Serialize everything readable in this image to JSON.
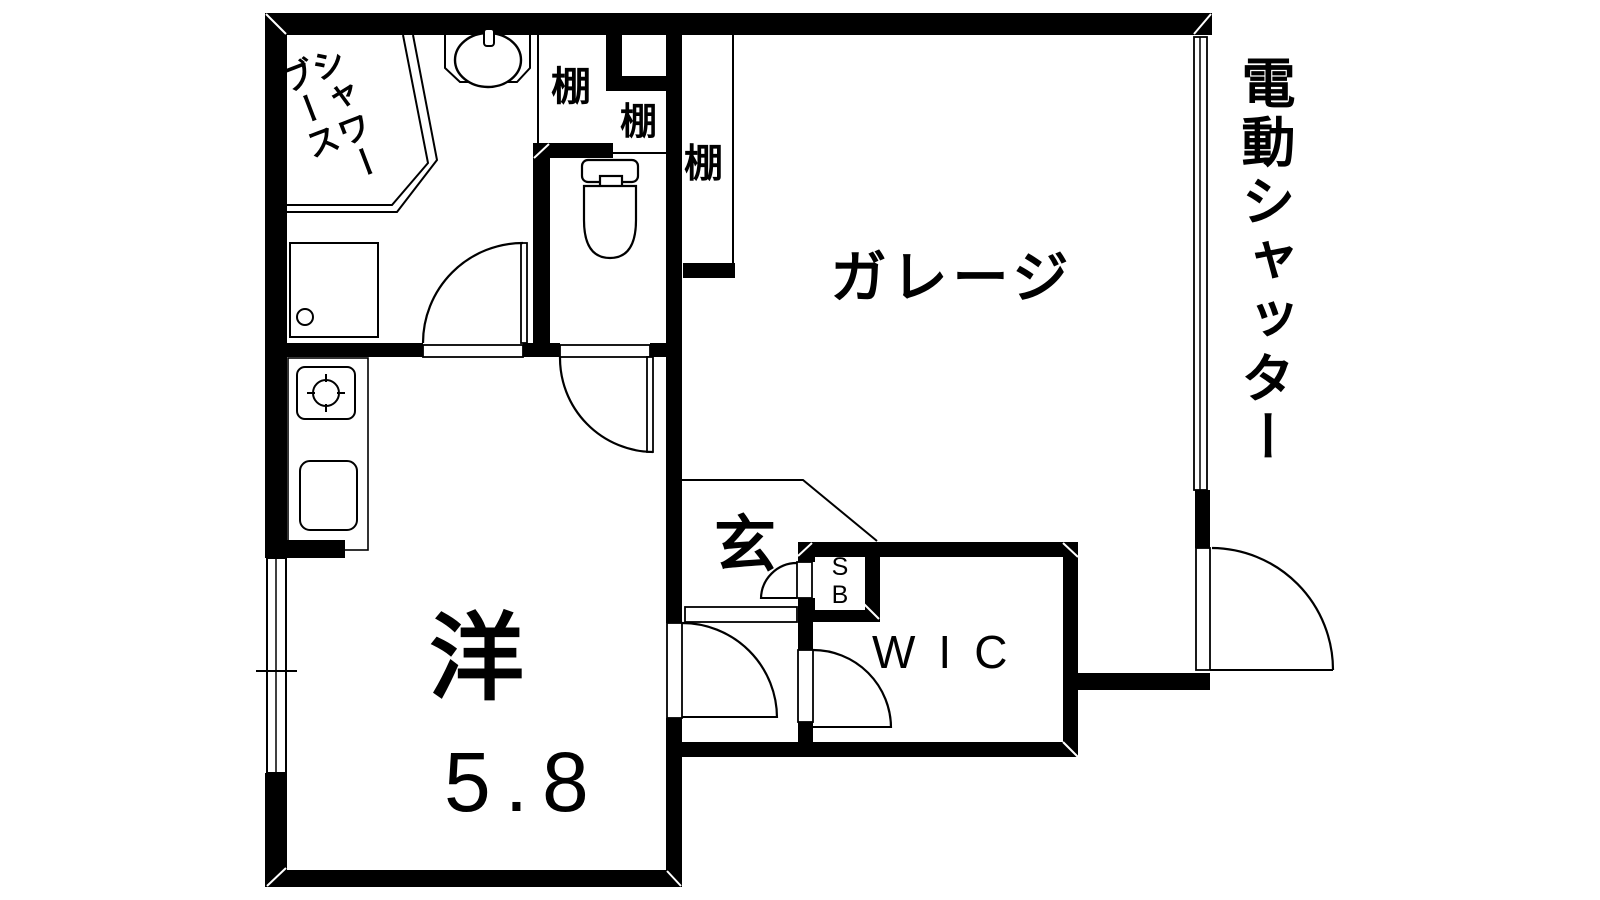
{
  "title": "floor-plan",
  "rooms": {
    "shower_booth": {
      "label_lines": [
        "シャワー",
        "ブース"
      ]
    },
    "washroom_shelf": {
      "label": "棚"
    },
    "toilet_shelf": {
      "label": "棚"
    },
    "garage_shelf": {
      "label": "棚"
    },
    "garage": {
      "label": "ガレージ"
    },
    "entrance": {
      "label": "玄"
    },
    "shoe_box": {
      "label_lines": [
        "S",
        "B"
      ]
    },
    "wic": {
      "label": "WIC"
    },
    "western_room": {
      "label": "洋",
      "size_label": "5.8"
    }
  },
  "annotations": {
    "electric_shutter": "電動シャッター"
  },
  "fixtures": [
    "washbasin",
    "toilet",
    "shower-tray",
    "stove",
    "kitchen-sink",
    "window",
    "shutter"
  ],
  "colors": {
    "wall": "#000000",
    "background": "#ffffff",
    "line": "#000000"
  }
}
